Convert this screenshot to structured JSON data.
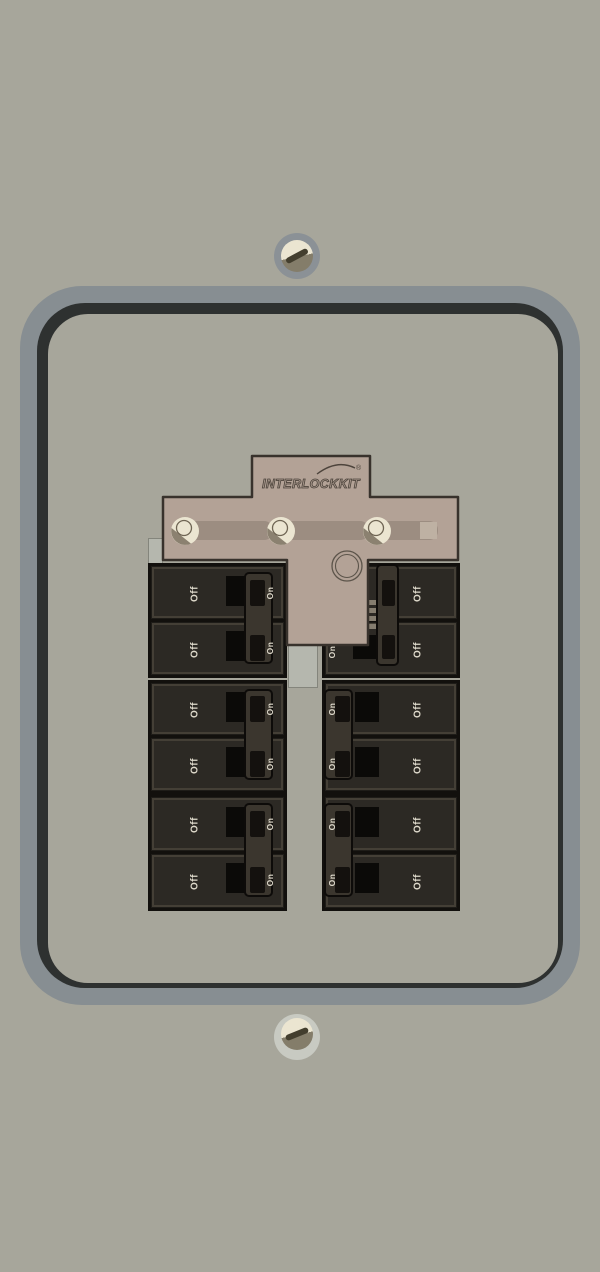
{
  "panel": {
    "background_color": "#a7a69b",
    "frame_outer_color": "#878e92",
    "frame_shadow_color": "#2e3130",
    "mounting_screws": [
      "top",
      "bottom"
    ]
  },
  "interlock": {
    "brand": "INTERLOCKKIT",
    "registered_mark": "®",
    "plate_color": "#b3a296",
    "slot_count": 3,
    "screw_count": 3
  },
  "breakers": {
    "off_label": "Off",
    "on_label": "On",
    "units": [
      {
        "id": "left-1",
        "column": "left",
        "row": 1,
        "label": "Off"
      },
      {
        "id": "left-2",
        "column": "left",
        "row": 2,
        "label": "Off"
      },
      {
        "id": "left-3",
        "column": "left",
        "row": 3,
        "label": "Off"
      },
      {
        "id": "left-4",
        "column": "left",
        "row": 4,
        "label": "Off"
      },
      {
        "id": "left-5",
        "column": "left",
        "row": 5,
        "label": "Off"
      },
      {
        "id": "left-6",
        "column": "left",
        "row": 6,
        "label": "Off"
      },
      {
        "id": "right-1",
        "column": "right",
        "row": 1,
        "label": "Off",
        "blocked_by_interlock": true
      },
      {
        "id": "right-2",
        "column": "right",
        "row": 2,
        "label": "Off",
        "blocked_by_interlock": true
      },
      {
        "id": "right-3",
        "column": "right",
        "row": 3,
        "label": "Off"
      },
      {
        "id": "right-4",
        "column": "right",
        "row": 4,
        "label": "Off"
      },
      {
        "id": "right-5",
        "column": "right",
        "row": 5,
        "label": "Off"
      },
      {
        "id": "right-6",
        "column": "right",
        "row": 6,
        "label": "Off"
      }
    ]
  }
}
